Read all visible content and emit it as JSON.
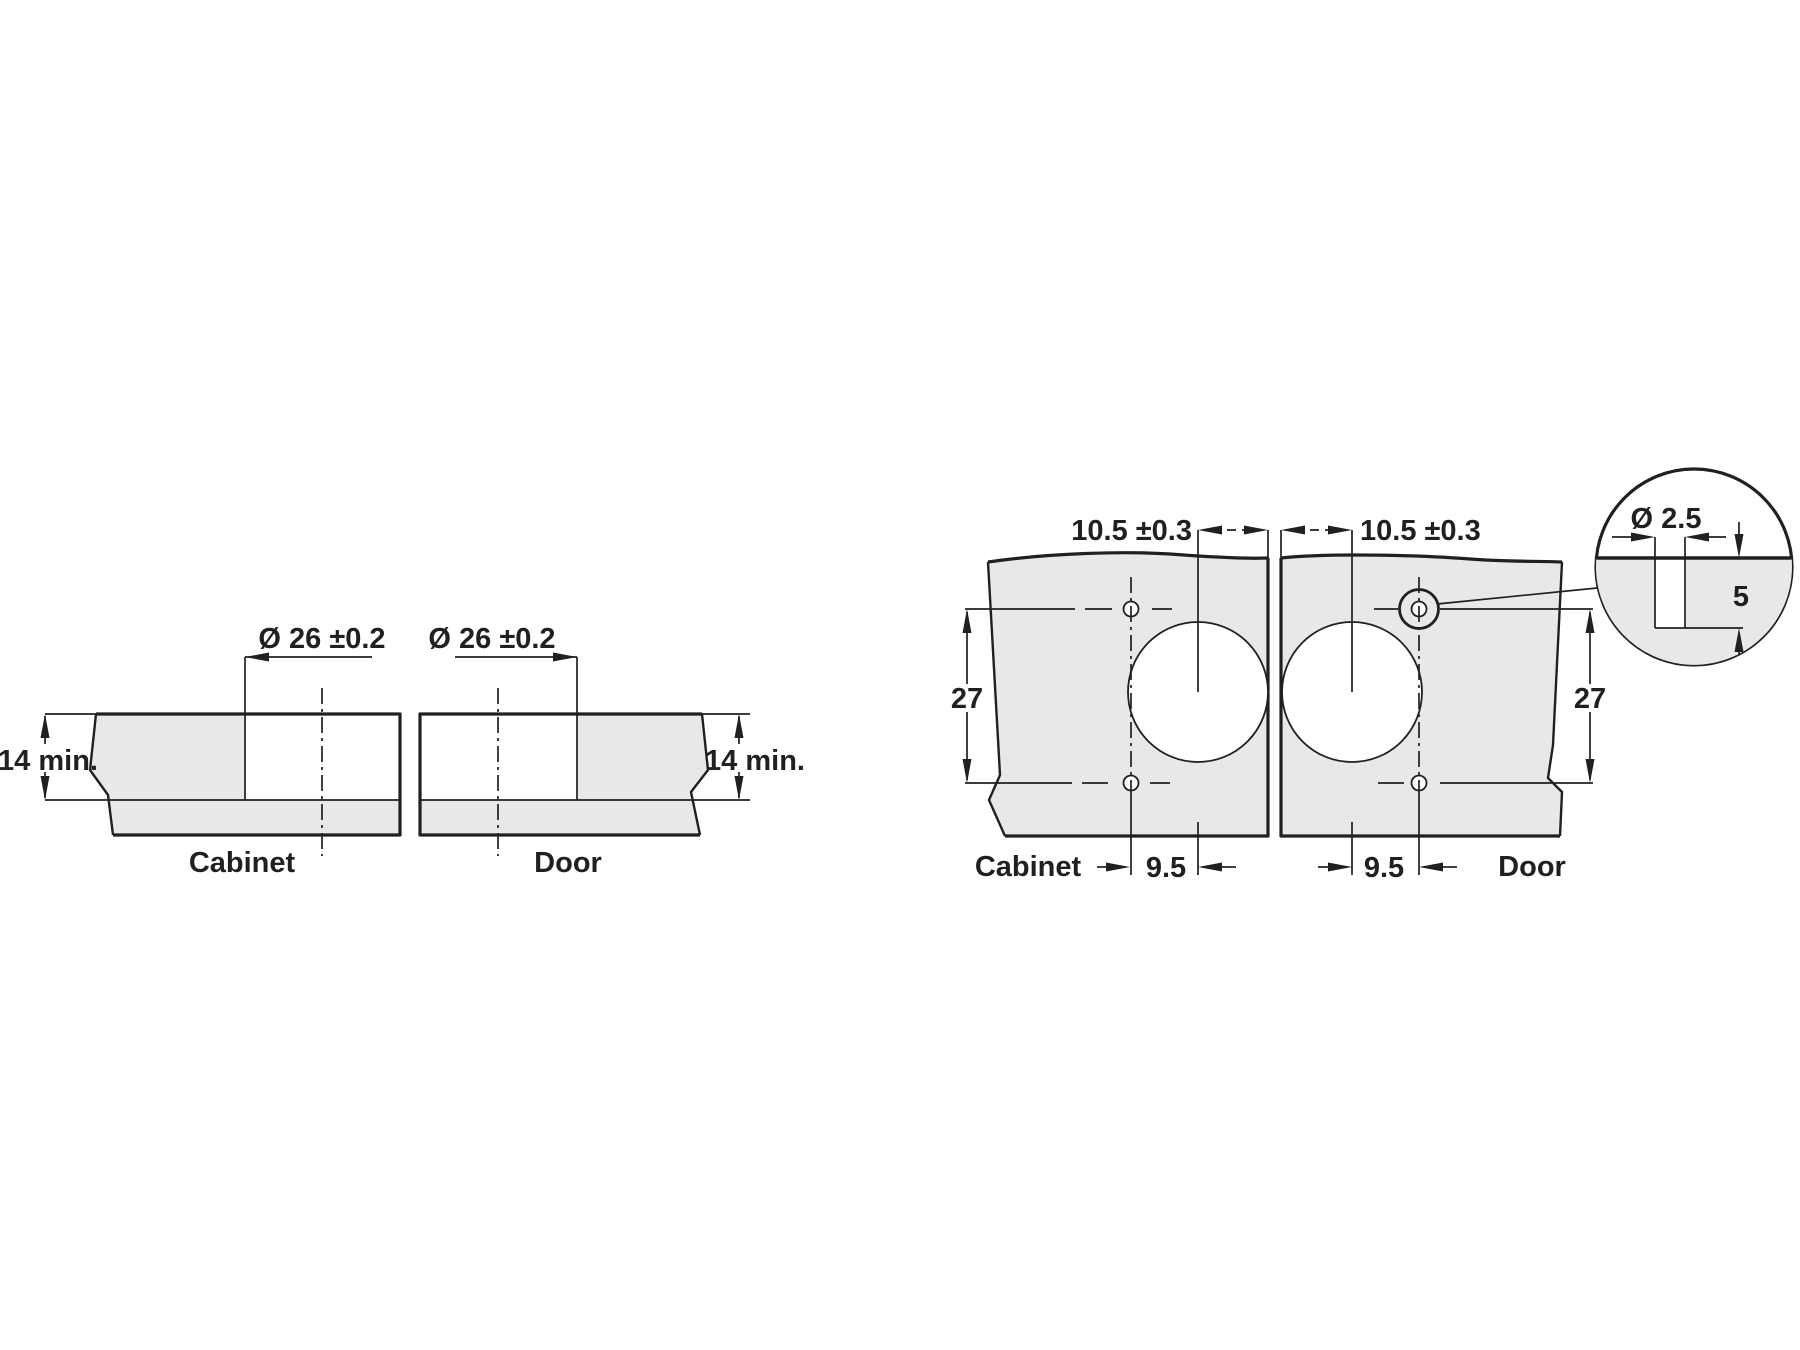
{
  "diagram": {
    "section_view": {
      "cabinet": {
        "caption": "Cabinet",
        "hole_diameter": "Ø 26 ±0.2",
        "min_thickness": "14 min."
      },
      "door": {
        "caption": "Door",
        "hole_diameter": "Ø 26 ±0.2",
        "min_thickness": "14 min."
      }
    },
    "plan_view": {
      "cabinet": {
        "caption": "Cabinet",
        "hole_edge_distance": "10.5 ±0.3",
        "screw_hole_spacing": "27",
        "screw_hole_offset": "9.5"
      },
      "door": {
        "caption": "Door",
        "hole_edge_distance": "10.5 ±0.3",
        "screw_hole_spacing": "27",
        "screw_hole_offset": "9.5"
      },
      "pilot_hole_detail": {
        "diameter": "Ø 2.5",
        "depth": "5"
      }
    },
    "colors": {
      "panel_fill": "#e8e8e8",
      "line_color": "#231f20",
      "background": "#ffffff"
    }
  }
}
